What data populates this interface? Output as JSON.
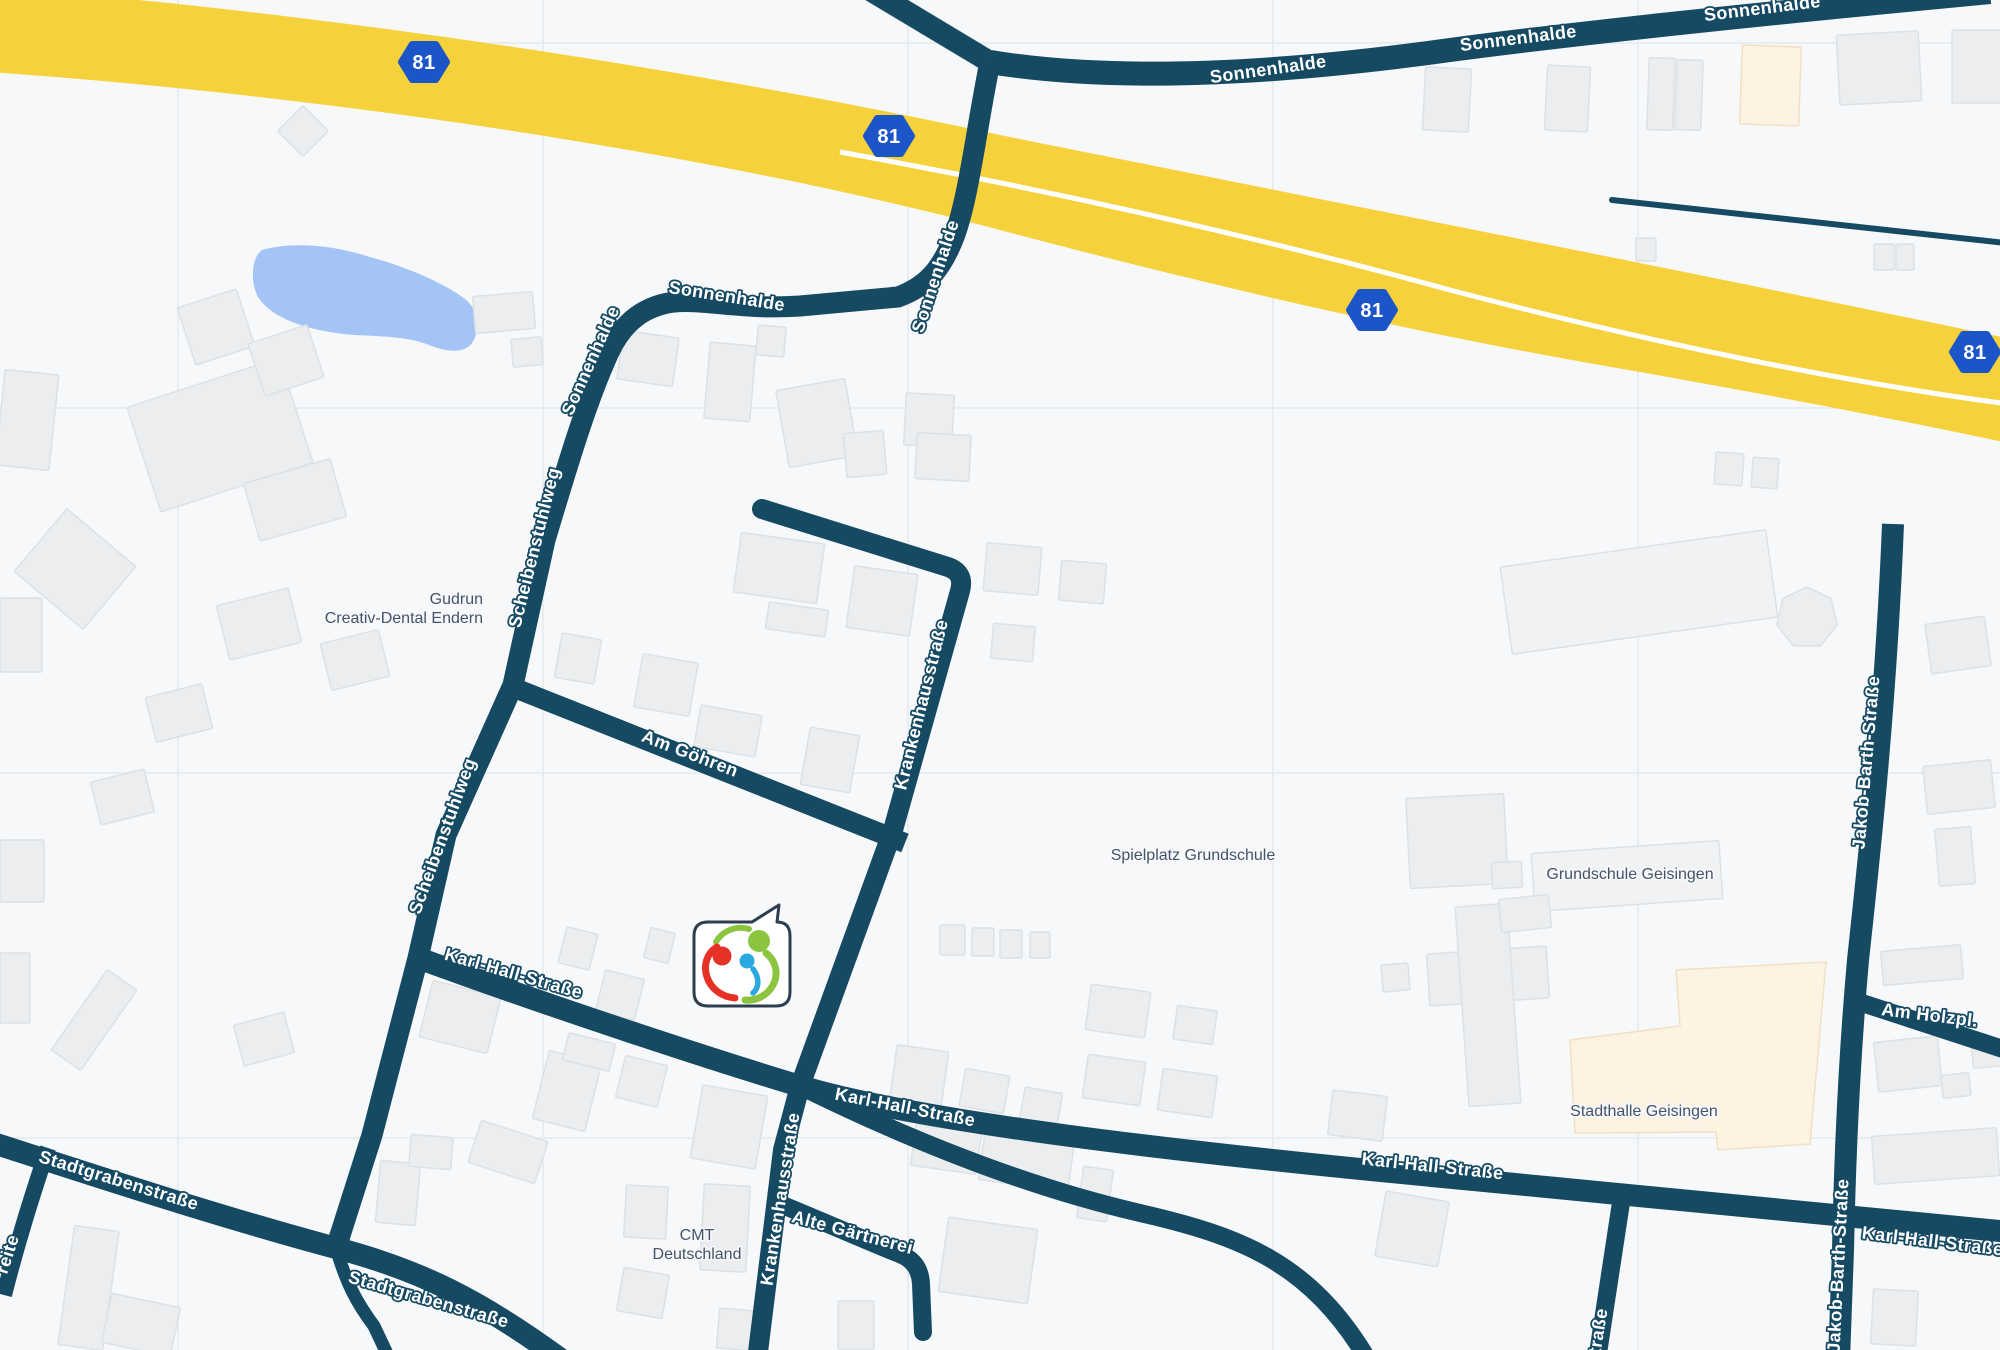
{
  "map": {
    "colors": {
      "background": "#f7f8fa",
      "gridline": "#eaedf0",
      "road": "#164a63",
      "road_label_text": "#ffffff",
      "poi_label_text": "#45536a",
      "highway": "#f5d23c",
      "highway_centerline": "#ffffff",
      "water": "#a4c4f5",
      "building_fill": "#ebedee",
      "building_stroke": "#dde1e4",
      "building_light_fill": "#f1f2f4",
      "building_cream_fill": "#fdf3e3",
      "building_cream_stroke": "#f1e0c2",
      "marker_border": "#2c3e50",
      "marker_fill": "#ffffff",
      "logo_red": "#e63127",
      "logo_green": "#8bc53f",
      "logo_blue": "#2aa9e0",
      "badge_fill": "#1b55c8",
      "badge_text": "#ffffff"
    },
    "grid": {
      "vertical_x": [
        178,
        543,
        908,
        1273,
        1638
      ],
      "horizontal_y": [
        43,
        408,
        773,
        1138
      ]
    },
    "highway": {
      "name": "A81",
      "band_path": "M -40,-15 C 300,8 700,70 1000,135 C 1200,175 1350,205 1550,245 C 1750,285 1920,320 2040,345 L 2040,450 C 1950,430 1800,400 1600,365 C 1400,330 1200,283 1000,230 C 700,150 300,92 -40,70 Z",
      "centerline_path": "M 840,152 C 1050,190 1250,235 1450,290 C 1640,340 1850,385 2040,408",
      "centerline_width": 5,
      "badge_label": "81",
      "badge_positions": [
        [
          424,
          62
        ],
        [
          889,
          136
        ],
        [
          1372,
          310
        ],
        [
          1975,
          352
        ]
      ]
    },
    "water": {
      "name": "pond",
      "path": "M 262,250 C 290,242 330,244 370,257 C 410,268 445,284 465,299 C 478,309 481,329 472,343 C 464,354 447,352 429,345 C 399,333 360,338 330,332 C 299,327 267,315 257,295 C 250,279 252,257 262,250 Z"
    },
    "roads": [
      {
        "id": "sonnenhalde-top",
        "d": "M 990,62 C 1100,80 1250,78 1450,50 C 1600,30 1800,10 1990,-8",
        "w": 24,
        "cap": "butt"
      },
      {
        "id": "sonnenhalde-branch-nw",
        "d": "M 990,62 L 870,-10",
        "w": 22,
        "cap": "butt"
      },
      {
        "id": "sonnenhalde-scheibenstuhlweg",
        "d": "M 990,62 C 976,130 968,205 952,242 C 941,268 928,286 898,297 L 800,306 C 742,310 704,299 674,302 C 644,306 623,322 609,352 C 586,402 566,470 545,540 L 513,685 L 446,835 L 418,958 L 372,1135 L 336,1248",
        "w": 21,
        "cap": "butt"
      },
      {
        "id": "am-goehren",
        "d": "M 512,687 L 905,843",
        "w": 20,
        "cap": "butt"
      },
      {
        "id": "krankenhausstrasse",
        "d": "M 762,509 L 948,567 Q 965,573 960,591 L 893,830 L 800,1086 L 783,1150 L 757,1360",
        "w": 20,
        "cap": "round"
      },
      {
        "id": "karl-hall-strasse",
        "d": "M 418,958 C 560,1010 720,1062 800,1086 C 920,1122 1180,1152 1432,1176 C 1620,1194 1800,1212 2010,1232",
        "w": 22,
        "cap": "butt"
      },
      {
        "id": "karl-hall-lower",
        "d": "M 800,1086 C 930,1150 1040,1190 1140,1213 C 1240,1236 1310,1262 1368,1360",
        "w": 18,
        "cap": "butt"
      },
      {
        "id": "stadtgrabenstrasse",
        "d": "M -10,1142 C 90,1174 210,1214 336,1248 C 420,1270 480,1300 562,1360",
        "w": 22,
        "cap": "butt"
      },
      {
        "id": "stadtgraben-branch",
        "d": "M 336,1248 C 346,1282 356,1302 374,1326 L 390,1360",
        "w": 13,
        "cap": "butt"
      },
      {
        "id": "breite-fragment",
        "d": "M 48,1148 C 32,1196 18,1240 4,1295",
        "w": 16,
        "cap": "butt"
      },
      {
        "id": "jakob-barth-strasse",
        "d": "M 1893,524 C 1886,700 1870,850 1858,960 C 1850,1050 1845,1150 1843,1250 L 1839,1360",
        "w": 22,
        "cap": "butt"
      },
      {
        "id": "am-holzpl",
        "d": "M 1853,1000 L 2012,1052",
        "w": 18,
        "cap": "butt"
      },
      {
        "id": "strasse-fragment",
        "d": "M 1622,1196 L 1597,1360",
        "w": 18,
        "cap": "butt"
      },
      {
        "id": "thin-road-ne",
        "d": "M 1612,200 L 2006,243",
        "w": 6,
        "cap": "round"
      },
      {
        "id": "alte-gaertnerei",
        "d": "M 780,1204 C 824,1222 872,1243 902,1255 Q 920,1263 921,1284 L 923,1332",
        "w": 18,
        "cap": "round"
      }
    ],
    "buildings": [
      {
        "x": 285,
        "y": 113,
        "w": 36,
        "h": 36,
        "r": 45
      },
      {
        "x": 474,
        "y": 294,
        "w": 60,
        "h": 37,
        "r": -5
      },
      {
        "x": 512,
        "y": 338,
        "w": 30,
        "h": 28,
        "r": -5
      },
      {
        "x": 140,
        "y": 380,
        "w": 160,
        "h": 110,
        "r": -18
      },
      {
        "x": 185,
        "y": 297,
        "w": 62,
        "h": 60,
        "r": -18
      },
      {
        "x": 255,
        "y": 333,
        "w": 62,
        "h": 55,
        "r": -18
      },
      {
        "x": 250,
        "y": 470,
        "w": 90,
        "h": 60,
        "r": -16
      },
      {
        "x": 0,
        "y": 372,
        "w": 54,
        "h": 96,
        "r": 6
      },
      {
        "x": 30,
        "y": 528,
        "w": 90,
        "h": 82,
        "r": 40
      },
      {
        "x": 222,
        "y": 596,
        "w": 74,
        "h": 56,
        "r": -14
      },
      {
        "x": 0,
        "y": 598,
        "w": 42,
        "h": 74,
        "r": 0
      },
      {
        "x": 325,
        "y": 636,
        "w": 60,
        "h": 48,
        "r": -14
      },
      {
        "x": 150,
        "y": 690,
        "w": 58,
        "h": 46,
        "r": -14
      },
      {
        "x": 95,
        "y": 775,
        "w": 55,
        "h": 44,
        "r": -14
      },
      {
        "x": 0,
        "y": 840,
        "w": 44,
        "h": 62,
        "r": 0
      },
      {
        "x": 45,
        "y": 1002,
        "w": 98,
        "h": 36,
        "r": -55
      },
      {
        "x": 238,
        "y": 1018,
        "w": 52,
        "h": 42,
        "r": -15
      },
      {
        "x": 0,
        "y": 953,
        "w": 30,
        "h": 70,
        "r": 0
      },
      {
        "x": 620,
        "y": 334,
        "w": 56,
        "h": 49,
        "r": 8
      },
      {
        "x": 707,
        "y": 344,
        "w": 46,
        "h": 76,
        "r": 5
      },
      {
        "x": 757,
        "y": 326,
        "w": 28,
        "h": 30,
        "r": 5
      },
      {
        "x": 782,
        "y": 384,
        "w": 70,
        "h": 78,
        "r": -10
      },
      {
        "x": 845,
        "y": 432,
        "w": 40,
        "h": 44,
        "r": -5
      },
      {
        "x": 905,
        "y": 394,
        "w": 48,
        "h": 52,
        "r": 3
      },
      {
        "x": 916,
        "y": 434,
        "w": 54,
        "h": 46,
        "r": 3
      },
      {
        "x": 985,
        "y": 545,
        "w": 55,
        "h": 48,
        "r": 5
      },
      {
        "x": 1060,
        "y": 562,
        "w": 45,
        "h": 40,
        "r": 5
      },
      {
        "x": 992,
        "y": 625,
        "w": 42,
        "h": 35,
        "r": 5
      },
      {
        "x": 737,
        "y": 538,
        "w": 84,
        "h": 60,
        "r": 8
      },
      {
        "x": 850,
        "y": 570,
        "w": 64,
        "h": 62,
        "r": 8
      },
      {
        "x": 767,
        "y": 606,
        "w": 60,
        "h": 27,
        "r": 8
      },
      {
        "x": 638,
        "y": 658,
        "w": 56,
        "h": 54,
        "r": 10
      },
      {
        "x": 558,
        "y": 636,
        "w": 40,
        "h": 45,
        "r": 10
      },
      {
        "x": 697,
        "y": 710,
        "w": 62,
        "h": 42,
        "r": 10
      },
      {
        "x": 805,
        "y": 731,
        "w": 50,
        "h": 58,
        "r": 10
      },
      {
        "x": 562,
        "y": 930,
        "w": 32,
        "h": 37,
        "r": 14
      },
      {
        "x": 600,
        "y": 974,
        "w": 40,
        "h": 42,
        "r": 14
      },
      {
        "x": 647,
        "y": 930,
        "w": 25,
        "h": 31,
        "r": 14
      },
      {
        "x": 425,
        "y": 988,
        "w": 70,
        "h": 58,
        "r": 14
      },
      {
        "x": 540,
        "y": 1056,
        "w": 54,
        "h": 70,
        "r": 14
      },
      {
        "x": 565,
        "y": 1038,
        "w": 48,
        "h": 28,
        "r": 14
      },
      {
        "x": 620,
        "y": 1060,
        "w": 43,
        "h": 43,
        "r": 14
      },
      {
        "x": 696,
        "y": 1090,
        "w": 66,
        "h": 74,
        "r": 10
      },
      {
        "x": 893,
        "y": 1048,
        "w": 52,
        "h": 58,
        "r": 8
      },
      {
        "x": 962,
        "y": 1072,
        "w": 45,
        "h": 38,
        "r": 10
      },
      {
        "x": 1022,
        "y": 1090,
        "w": 38,
        "h": 34,
        "r": 10
      },
      {
        "x": 940,
        "y": 925,
        "w": 25,
        "h": 30,
        "r": 0
      },
      {
        "x": 972,
        "y": 928,
        "w": 22,
        "h": 28,
        "r": 0
      },
      {
        "x": 1000,
        "y": 930,
        "w": 22,
        "h": 28,
        "r": 0
      },
      {
        "x": 1030,
        "y": 932,
        "w": 20,
        "h": 26,
        "r": 0
      },
      {
        "x": 1088,
        "y": 988,
        "w": 60,
        "h": 46,
        "r": 8
      },
      {
        "x": 1175,
        "y": 1008,
        "w": 40,
        "h": 34,
        "r": 8
      },
      {
        "x": 1408,
        "y": 796,
        "w": 98,
        "h": 90,
        "r": -3
      },
      {
        "x": 1492,
        "y": 862,
        "w": 30,
        "h": 26,
        "r": -3
      },
      {
        "x": 1428,
        "y": 950,
        "w": 120,
        "h": 52,
        "r": -4
      },
      {
        "x": 1462,
        "y": 905,
        "w": 52,
        "h": 200,
        "r": -4
      },
      {
        "x": 1382,
        "y": 964,
        "w": 27,
        "h": 27,
        "r": -5
      },
      {
        "x": 1533,
        "y": 847,
        "w": 188,
        "h": 58,
        "r": -4,
        "style": "light"
      },
      {
        "x": 1500,
        "y": 897,
        "w": 50,
        "h": 33,
        "r": -6
      },
      {
        "x": 1505,
        "y": 548,
        "w": 268,
        "h": 88,
        "r": -8,
        "style": "light"
      },
      {
        "x": 1928,
        "y": 620,
        "w": 60,
        "h": 50,
        "r": -8
      },
      {
        "x": 1925,
        "y": 763,
        "w": 68,
        "h": 48,
        "r": -6
      },
      {
        "x": 1937,
        "y": 828,
        "w": 36,
        "h": 57,
        "r": -5
      },
      {
        "x": 1715,
        "y": 453,
        "w": 28,
        "h": 32,
        "r": 4
      },
      {
        "x": 1752,
        "y": 458,
        "w": 26,
        "h": 30,
        "r": 4
      },
      {
        "x": 1424,
        "y": 68,
        "w": 46,
        "h": 63,
        "r": 3
      },
      {
        "x": 1546,
        "y": 66,
        "w": 43,
        "h": 65,
        "r": 3
      },
      {
        "x": 1648,
        "y": 58,
        "w": 26,
        "h": 72,
        "r": 2
      },
      {
        "x": 1676,
        "y": 60,
        "w": 26,
        "h": 70,
        "r": 2
      },
      {
        "x": 1741,
        "y": 46,
        "w": 59,
        "h": 79,
        "r": 2,
        "style": "cream"
      },
      {
        "x": 1838,
        "y": 33,
        "w": 82,
        "h": 70,
        "r": -3
      },
      {
        "x": 1952,
        "y": 30,
        "w": 50,
        "h": 73,
        "r": 0
      },
      {
        "x": 1874,
        "y": 244,
        "w": 20,
        "h": 26,
        "r": 0
      },
      {
        "x": 1896,
        "y": 244,
        "w": 18,
        "h": 26,
        "r": 0
      },
      {
        "x": 1636,
        "y": 238,
        "w": 20,
        "h": 23,
        "r": 0
      },
      {
        "x": 1882,
        "y": 948,
        "w": 80,
        "h": 34,
        "r": -5
      },
      {
        "x": 1876,
        "y": 1039,
        "w": 64,
        "h": 50,
        "r": -6
      },
      {
        "x": 1942,
        "y": 1074,
        "w": 28,
        "h": 23,
        "r": -6
      },
      {
        "x": 1972,
        "y": 1039,
        "w": 50,
        "h": 27,
        "r": -6
      },
      {
        "x": 1873,
        "y": 1132,
        "w": 125,
        "h": 48,
        "r": -4
      },
      {
        "x": 1872,
        "y": 1290,
        "w": 45,
        "h": 55,
        "r": 3
      },
      {
        "x": 1380,
        "y": 1196,
        "w": 64,
        "h": 66,
        "r": 10
      },
      {
        "x": 913,
        "y": 1128,
        "w": 66,
        "h": 42,
        "r": 8
      },
      {
        "x": 982,
        "y": 1128,
        "w": 90,
        "h": 58,
        "r": 8
      },
      {
        "x": 943,
        "y": 1223,
        "w": 90,
        "h": 75,
        "r": 8
      },
      {
        "x": 1080,
        "y": 1168,
        "w": 30,
        "h": 52,
        "r": 8
      },
      {
        "x": 625,
        "y": 1186,
        "w": 42,
        "h": 52,
        "r": 3
      },
      {
        "x": 702,
        "y": 1185,
        "w": 46,
        "h": 86,
        "r": 3
      },
      {
        "x": 620,
        "y": 1271,
        "w": 46,
        "h": 44,
        "r": 10
      },
      {
        "x": 718,
        "y": 1310,
        "w": 48,
        "h": 40,
        "r": 5
      },
      {
        "x": 838,
        "y": 1301,
        "w": 36,
        "h": 48,
        "r": 0
      },
      {
        "x": 66,
        "y": 1228,
        "w": 45,
        "h": 120,
        "r": 8
      },
      {
        "x": 106,
        "y": 1300,
        "w": 70,
        "h": 50,
        "r": 12
      },
      {
        "x": 378,
        "y": 1162,
        "w": 40,
        "h": 62,
        "r": 5
      },
      {
        "x": 410,
        "y": 1136,
        "w": 42,
        "h": 32,
        "r": 5
      },
      {
        "x": 473,
        "y": 1130,
        "w": 70,
        "h": 44,
        "r": 18
      },
      {
        "x": 1085,
        "y": 1058,
        "w": 58,
        "h": 44,
        "r": 8
      },
      {
        "x": 1160,
        "y": 1072,
        "w": 55,
        "h": 42,
        "r": 8
      },
      {
        "x": 1330,
        "y": 1093,
        "w": 55,
        "h": 45,
        "r": 7
      }
    ],
    "heptagon": {
      "cx": 1807,
      "cy": 618,
      "r": 31
    },
    "stadthalle_polygon": "1570,1040 1680,1026 1676,970 1826,962 1810,1144 1718,1150 1716,1132 1575,1133",
    "street_labels": [
      {
        "text": "Sonnenhalde",
        "x": 1269,
        "y": 75,
        "rot": -8
      },
      {
        "text": "Sonnenhalde",
        "x": 1519,
        "y": 44,
        "rot": -7
      },
      {
        "text": "Sonnenhalde",
        "x": 1763,
        "y": 14,
        "rot": -7
      },
      {
        "text": "Sonnenhalde",
        "x": 941,
        "y": 278,
        "rot": -72
      },
      {
        "text": "Sonnenhalde",
        "x": 726,
        "y": 302,
        "rot": 9
      },
      {
        "text": "Sonnenhalde",
        "x": 596,
        "y": 363,
        "rot": -66
      },
      {
        "text": "Scheibenstuhlweg",
        "x": 540,
        "y": 549,
        "rot": -76
      },
      {
        "text": "Scheibenstuhlweg",
        "x": 448,
        "y": 838,
        "rot": -70
      },
      {
        "text": "Am Göhren",
        "x": 688,
        "y": 759,
        "rot": 21
      },
      {
        "text": "Krankenhausstraße",
        "x": 927,
        "y": 706,
        "rot": -76
      },
      {
        "text": "Krankenhausstraße",
        "x": 786,
        "y": 1200,
        "rot": -81
      },
      {
        "text": "Karl-Hall-Straße",
        "x": 512,
        "y": 979,
        "rot": 16
      },
      {
        "text": "Karl-Hall-Straße",
        "x": 904,
        "y": 1113,
        "rot": 11
      },
      {
        "text": "Karl-Hall-Straße",
        "x": 1432,
        "y": 1172,
        "rot": 6
      },
      {
        "text": "Karl-Hall-Straße",
        "x": 1932,
        "y": 1247,
        "rot": 7
      },
      {
        "text": "Stadtgrabenstraße",
        "x": 117,
        "y": 1186,
        "rot": 17
      },
      {
        "text": "Stadtgrabenstraße",
        "x": 427,
        "y": 1305,
        "rot": 16
      },
      {
        "text": "Alte Gärtnerei",
        "x": 851,
        "y": 1238,
        "rot": 15
      },
      {
        "text": "Jakob-Barth-Straße",
        "x": 1872,
        "y": 763,
        "rot": -85
      },
      {
        "text": "Jakob-Barth-Straße",
        "x": 1844,
        "y": 1266,
        "rot": -87
      },
      {
        "text": "Am Holzpl.",
        "x": 1929,
        "y": 1021,
        "rot": 7
      },
      {
        "text": "Straße",
        "x": 1603,
        "y": 1338,
        "rot": -81
      },
      {
        "text": "reite",
        "x": 13,
        "y": 1256,
        "rot": -72
      }
    ],
    "poi_labels": [
      {
        "id": "gudrun-creativ-dental",
        "lines": [
          "Gudrun",
          "Creativ-Dental Endern"
        ],
        "x": 483,
        "y": 604,
        "anchor": "end"
      },
      {
        "id": "spielplatz-grundschule",
        "lines": [
          "Spielplatz Grundschule"
        ],
        "x": 1193,
        "y": 860,
        "anchor": "middle"
      },
      {
        "id": "grundschule-geisingen",
        "lines": [
          "Grundschule Geisingen"
        ],
        "x": 1630,
        "y": 879,
        "anchor": "middle"
      },
      {
        "id": "stadthalle-geisingen",
        "lines": [
          "Stadthalle Geisingen"
        ],
        "x": 1644,
        "y": 1116,
        "anchor": "middle"
      },
      {
        "id": "cmt-deutschland",
        "lines": [
          "CMT",
          "Deutschland"
        ],
        "x": 697,
        "y": 1240,
        "anchor": "middle"
      }
    ],
    "marker": {
      "bubble_path": "M 708,922 L 752,922 L 779,905 L 777,922 Q 790,922 790,936 L 790,992 Q 790,1006 776,1006 L 708,1006 Q 694,1006 694,992 L 694,936 Q 694,922 708,922 Z",
      "logo": {
        "heads": [
          {
            "cx": 722,
            "cy": 956,
            "r": 9.5,
            "color": "logo_red"
          },
          {
            "cx": 759,
            "cy": 941,
            "r": 11,
            "color": "logo_green"
          },
          {
            "cx": 747,
            "cy": 961,
            "r": 7.5,
            "color": "logo_blue"
          }
        ],
        "arcs": [
          {
            "d": "M 716,942 C 722,931 736,925 749,929",
            "w": 6,
            "color": "logo_green"
          },
          {
            "d": "M 766,953 C 776,961 779,974 773,985 C 767,996 756,1001 745,1000",
            "w": 7,
            "color": "logo_green"
          },
          {
            "d": "M 717,947 C 707,953 703,965 707,977 C 711,989 722,997 735,998",
            "w": 7,
            "color": "logo_red"
          },
          {
            "d": "M 753,969 C 759,977 760,987 753,993",
            "w": 5.5,
            "color": "logo_blue"
          }
        ]
      }
    }
  }
}
